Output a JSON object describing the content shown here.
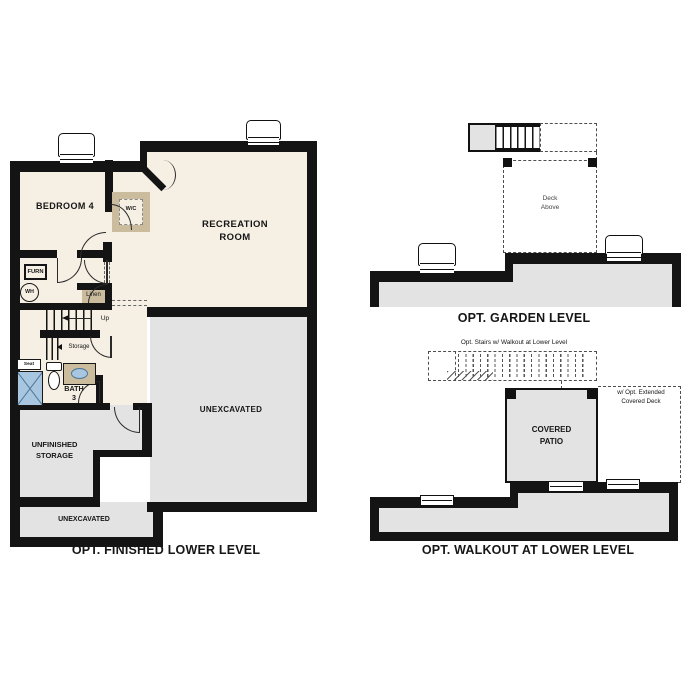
{
  "palette": {
    "wall": "#141414",
    "cream": "#f6efe3",
    "gray": "#e3e3e3",
    "tan": "#cbbc9e",
    "blue": "#a9c6e0",
    "blue_dark": "#4d7699",
    "line": "#2a2a2a",
    "dash": "#4d4d4d"
  },
  "ll": {
    "caption": "OPT. FINISHED LOWER LEVEL",
    "bedroom": "BEDROOM 4",
    "wc": "W/C",
    "recreation_line1": "RECREATION",
    "recreation_line2": "ROOM",
    "furn": "FURN",
    "wh": "WH",
    "linen": "Linen",
    "up": "Up",
    "storage": "Storage",
    "seat": "Seat",
    "bath_line1": "BATH",
    "bath_line2": "3",
    "unexcavated": "UNEXCAVATED",
    "unfinished_line1": "UNFINISHED",
    "unfinished_line2": "STORAGE",
    "unexcavated_small": "UNEXCAVATED"
  },
  "gl": {
    "caption": "OPT. GARDEN LEVEL",
    "deck_line1": "Deck",
    "deck_line2": "Above"
  },
  "wl": {
    "caption": "OPT. WALKOUT AT LOWER LEVEL",
    "stairs_note": "Opt. Stairs w/ Walkout at Lower Level",
    "deck_note_line1": "w/ Opt. Extended",
    "deck_note_line2": "Covered Deck",
    "patio_line1": "COVERED",
    "patio_line2": "PATIO"
  }
}
